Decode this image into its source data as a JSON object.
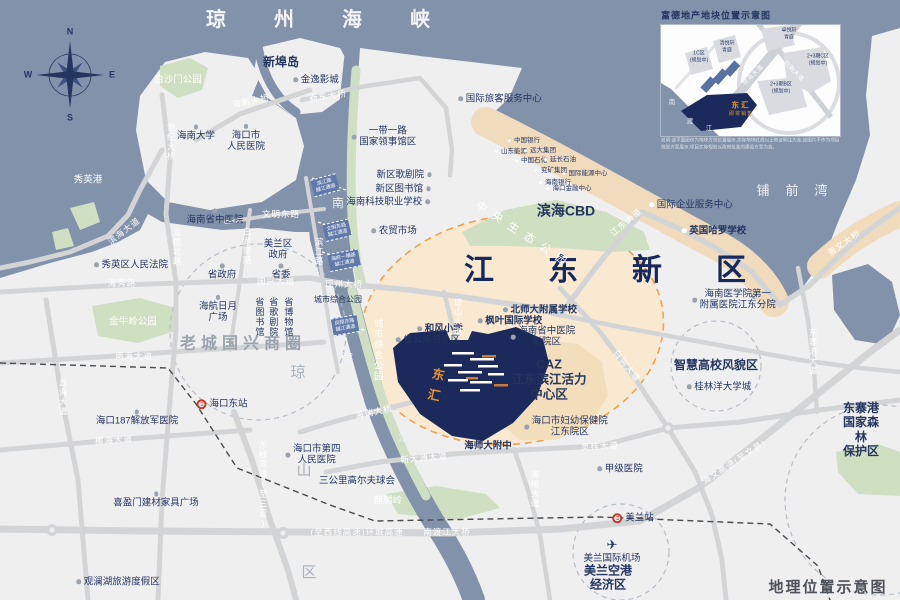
{
  "page": {
    "kind": "real-estate location map",
    "project": "东汇"
  },
  "labels": {
    "sea": [
      {
        "t": "琼州海峡",
        "x": 342,
        "y": 20,
        "c": "seabig",
        "n": "strait-title"
      },
      {
        "t": "铺前湾",
        "x": 800,
        "y": 191,
        "c": "seamed"
      },
      {
        "t": "秀英港",
        "x": 88,
        "y": 180,
        "c": "wsm"
      },
      {
        "t": "南",
        "x": 338,
        "y": 203,
        "c": "riv"
      },
      {
        "t": "渡",
        "x": 347,
        "y": 358,
        "c": "riv"
      },
      {
        "t": "江",
        "x": 404,
        "y": 437,
        "c": "riv"
      }
    ],
    "districts": [
      {
        "t": "江东新区",
        "x": 632,
        "y": 271,
        "c": "dist",
        "n": "district-title"
      },
      {
        "t": "老城国兴商圈",
        "x": 243,
        "y": 344,
        "c": "graybig"
      },
      {
        "t": "滨海CBD",
        "x": 566,
        "y": 211,
        "c": "b s14"
      },
      {
        "t": "CAZ\n江东滨江活力\n中心区",
        "x": 549,
        "y": 380,
        "c": "b s13"
      },
      {
        "t": "智慧高校风貌区",
        "x": 716,
        "y": 365,
        "c": "b s12"
      },
      {
        "t": "美兰空港\n经济区",
        "x": 608,
        "y": 578,
        "c": "b s12"
      },
      {
        "t": "东寨港\n国家森林\n保护区",
        "x": 861,
        "y": 430,
        "c": "b s12"
      },
      {
        "t": "中央生态公园",
        "x": 524,
        "y": 236,
        "c": "wmid",
        "r": 33
      },
      {
        "t": "城市综合公园",
        "x": 338,
        "y": 300,
        "c": "s8"
      },
      {
        "t": "城市综合公园",
        "x": 377,
        "y": 350,
        "c": "wsm v s8"
      },
      {
        "t": "琼",
        "x": 298,
        "y": 373,
        "c": "graych"
      },
      {
        "t": "山",
        "x": 304,
        "y": 471,
        "c": "graych"
      },
      {
        "t": "区",
        "x": 309,
        "y": 573,
        "c": "graych"
      },
      {
        "t": "地理位置示意图",
        "x": 828,
        "y": 588,
        "c": "corner",
        "n": "corner-title"
      }
    ],
    "pois": [
      {
        "t": "新埠岛",
        "x": 281,
        "y": 62,
        "c": "b s12"
      },
      {
        "t": "金逸影城",
        "x": 316,
        "y": 80,
        "d": "l"
      },
      {
        "t": "白沙门公园",
        "x": 178,
        "y": 80,
        "c": "wsm"
      },
      {
        "t": "海南大学",
        "x": 196,
        "y": 133,
        "d": "t"
      },
      {
        "t": "海口市\n人民医院",
        "x": 246,
        "y": 138,
        "d": "t"
      },
      {
        "t": "国际旅客服务中心",
        "x": 500,
        "y": 99,
        "d": "l"
      },
      {
        "t": "一带一路\n国家领事馆区",
        "x": 384,
        "y": 137,
        "d": "l"
      },
      {
        "t": "新区歌剧院",
        "x": 404,
        "y": 175,
        "d": "r"
      },
      {
        "t": "新区图书馆",
        "x": 403,
        "y": 189,
        "d": "r"
      },
      {
        "t": "海南科技职业学校",
        "x": 388,
        "y": 202,
        "d": "r"
      },
      {
        "t": "农贸市场",
        "x": 394,
        "y": 231,
        "d": "l"
      },
      {
        "t": "中国银行",
        "x": 524,
        "y": 141,
        "c": "t7 sm",
        "d": "l",
        "dc": "w"
      },
      {
        "t": "山东能源",
        "x": 511,
        "y": 152,
        "c": "t7 sm",
        "d": "l",
        "dc": "w"
      },
      {
        "t": "远大集团",
        "x": 540,
        "y": 151,
        "c": "t7 sm",
        "d": "l",
        "dc": "w"
      },
      {
        "t": "中国石化",
        "x": 531,
        "y": 161,
        "c": "t7 sm",
        "d": "l",
        "dc": "w"
      },
      {
        "t": "延长石油",
        "x": 560,
        "y": 160,
        "c": "t7 sm",
        "d": "l",
        "dc": "w"
      },
      {
        "t": "兖矿集团",
        "x": 551,
        "y": 171,
        "c": "t7 sm",
        "d": "l",
        "dc": "w"
      },
      {
        "t": "国际能源中心",
        "x": 585,
        "y": 174,
        "c": "t7 sm",
        "d": "l",
        "dc": "w"
      },
      {
        "t": "海南银行",
        "x": 555,
        "y": 183,
        "c": "t7 sm",
        "d": "l",
        "dc": "w"
      },
      {
        "t": "海口金融中心",
        "x": 569,
        "y": 189,
        "c": "t7 sm",
        "d": "l",
        "dc": "w"
      },
      {
        "t": "国际企业服务中心",
        "x": 691,
        "y": 205,
        "d": "l",
        "dc": "w"
      },
      {
        "t": "英国哈罗学校",
        "x": 714,
        "y": 231,
        "c": "b",
        "d": "l",
        "dc": "w"
      },
      {
        "t": "秀英区人民法院",
        "x": 131,
        "y": 265,
        "d": "l"
      },
      {
        "t": "省政府",
        "x": 222,
        "y": 272,
        "d": "t"
      },
      {
        "t": "省委",
        "x": 281,
        "y": 272,
        "d": "t"
      },
      {
        "t": "美兰区\n政府",
        "x": 278,
        "y": 250
      },
      {
        "t": "海航日月\n广场",
        "x": 218,
        "y": 309,
        "d": "t"
      },
      {
        "t": "省图书馆",
        "x": 259,
        "y": 317,
        "c": "v s9"
      },
      {
        "t": "省歌剧院",
        "x": 273,
        "y": 317,
        "c": "v s9"
      },
      {
        "t": "省博物馆",
        "x": 288,
        "y": 317,
        "c": "v s9"
      },
      {
        "t": "海口东站",
        "x": 222,
        "y": 404,
        "i": "rail",
        "n": "haikou-east-station"
      },
      {
        "t": "海口187解放军医院",
        "x": 137,
        "y": 418,
        "d": "t"
      },
      {
        "t": "喜盈门建材家具广场",
        "x": 156,
        "y": 500,
        "d": "t"
      },
      {
        "t": "观澜湖旅游度假区",
        "x": 118,
        "y": 582,
        "d": "l"
      },
      {
        "t": "海口市第四\n人民医院",
        "x": 313,
        "y": 455,
        "d": "l"
      },
      {
        "t": "三公里高尔夫球会",
        "x": 357,
        "y": 481
      },
      {
        "t": "麒麟岭",
        "x": 388,
        "y": 501,
        "c": "wsm"
      },
      {
        "t": "金牛岭公园",
        "x": 133,
        "y": 322,
        "c": "wsm"
      },
      {
        "t": "海南省中医院",
        "x": 215,
        "y": 217,
        "d": "t"
      },
      {
        "t": "和风小学",
        "x": 440,
        "y": 329,
        "c": "b",
        "d": "l"
      },
      {
        "t": "省公务员小区",
        "x": 428,
        "y": 340,
        "d": "l"
      },
      {
        "t": "北师大附属学校",
        "x": 540,
        "y": 310,
        "c": "b",
        "d": "l"
      },
      {
        "t": "枫叶国际学校",
        "x": 510,
        "y": 321,
        "c": "b",
        "d": "l"
      },
      {
        "t": "海南省中医院\n新院区",
        "x": 543,
        "y": 337,
        "d": "l"
      },
      {
        "t": "海口市妇幼保健院\n江东院区",
        "x": 566,
        "y": 427,
        "d": "l"
      },
      {
        "t": "海师大附中",
        "x": 488,
        "y": 446,
        "c": "b"
      },
      {
        "t": "甲级医院",
        "x": 620,
        "y": 469,
        "d": "l"
      },
      {
        "t": "美兰站",
        "x": 633,
        "y": 518,
        "i": "rail",
        "n": "meilan-station"
      },
      {
        "t": "美兰国际机场",
        "x": 612,
        "y": 551,
        "i": "plane",
        "c": "dtop",
        "n": "meilan-airport"
      },
      {
        "t": "桂林洋大学城",
        "x": 719,
        "y": 387,
        "d": "l"
      },
      {
        "t": "海南医学院第一\n附属医院江东分院",
        "x": 734,
        "y": 300,
        "d": "l"
      }
    ],
    "roads": [
      {
        "t": "海新大桥",
        "x": 251,
        "y": 101,
        "c": "rd",
        "r": -12
      },
      {
        "t": "新东大桥",
        "x": 328,
        "y": 96,
        "c": "rd",
        "r": -8
      },
      {
        "t": "世纪大桥",
        "x": 171,
        "y": 142,
        "c": "rd v"
      },
      {
        "t": "滨海大道",
        "x": 124,
        "y": 231,
        "c": "rd",
        "r": -38
      },
      {
        "t": "海秀路",
        "x": 122,
        "y": 283,
        "c": "rd"
      },
      {
        "t": "国兴大道",
        "x": 276,
        "y": 281,
        "c": "rd"
      },
      {
        "t": "文明东路",
        "x": 281,
        "y": 214,
        "c": "rd"
      },
      {
        "t": "白龙南路",
        "x": 247,
        "y": 246,
        "c": "rd v"
      },
      {
        "t": "龙昆北路",
        "x": 177,
        "y": 247,
        "c": "rd v"
      },
      {
        "t": "滨江路",
        "x": 319,
        "y": 252,
        "c": "rd v"
      },
      {
        "t": "琼州大桥",
        "x": 344,
        "y": 284,
        "c": "rd"
      },
      {
        "t": "南海大道",
        "x": 134,
        "y": 356,
        "c": "rd"
      },
      {
        "t": "丘海大道",
        "x": 63,
        "y": 397,
        "c": "rd v"
      },
      {
        "t": "椰海大道",
        "x": 114,
        "y": 440,
        "c": "rd",
        "r": -4
      },
      {
        "t": "东线高速(至三亚)",
        "x": 263,
        "y": 485,
        "c": "rd v s7"
      },
      {
        "t": "(至西线高速)环城高速",
        "x": 357,
        "y": 532,
        "c": "rd"
      },
      {
        "t": "南渡江大桥",
        "x": 447,
        "y": 532,
        "c": "rd"
      },
      {
        "t": "新大洲大道",
        "x": 424,
        "y": 458,
        "c": "rd",
        "r": -5
      },
      {
        "t": "海瑞大桥",
        "x": 374,
        "y": 412,
        "c": "rd",
        "r": -12
      },
      {
        "t": "琼山大道",
        "x": 458,
        "y": 317,
        "c": "rd v"
      },
      {
        "t": "灵桂大道",
        "x": 600,
        "y": 446,
        "c": "rd",
        "r": -3
      },
      {
        "t": "海榆大道",
        "x": 535,
        "y": 489,
        "c": "rd v"
      },
      {
        "t": "白驹大道",
        "x": 627,
        "y": 366,
        "c": "rd",
        "r": 52
      },
      {
        "t": "江东大道",
        "x": 626,
        "y": 222,
        "c": "rd",
        "r": -40
      },
      {
        "t": "东寨港大道",
        "x": 813,
        "y": 352,
        "c": "rd v s7"
      },
      {
        "t": "海文大桥",
        "x": 844,
        "y": 243,
        "c": "rd",
        "r": -35
      },
      {
        "t": "海文高速(至文昌)",
        "x": 734,
        "y": 462,
        "c": "rd s8",
        "r": -33
      }
    ],
    "tags": [
      {
        "t": "滨江路\n越江通道",
        "x": 325,
        "y": 185,
        "c": "btag",
        "r": -15
      },
      {
        "t": "文明东路\n越江通道",
        "x": 337,
        "y": 230,
        "c": "btag",
        "r": -13
      },
      {
        "t": "海府一横路\n越江通道",
        "x": 344,
        "y": 260,
        "c": "btag",
        "r": -11
      },
      {
        "t": "凤翔东路\n越江通道",
        "x": 345,
        "y": 325,
        "c": "btag",
        "r": -10
      }
    ],
    "project": [
      {
        "t": "东\n汇",
        "x": 436,
        "y": 386,
        "c": "oproj",
        "r": 12,
        "n": "project-site-label"
      }
    ],
    "inset": [
      {
        "t": "富德地产地块位置示意图",
        "x": 661,
        "y": 16,
        "c": "instt",
        "a": "l",
        "n": "inset-title"
      },
      {
        "t": "1C区\n(规划中)",
        "x": 699,
        "y": 57,
        "c": "ip"
      },
      {
        "t": "清悦轩\n青庭",
        "x": 727,
        "y": 47,
        "c": "ip"
      },
      {
        "t": "卓悦轩\n青庭",
        "x": 789,
        "y": 34,
        "c": "ip"
      },
      {
        "t": "2+3期C区\n(规划中)",
        "x": 818,
        "y": 60,
        "c": "ip"
      },
      {
        "t": "2+3期B区\n(规划中)",
        "x": 781,
        "y": 88,
        "c": "ip"
      },
      {
        "t": "东汇",
        "x": 741,
        "y": 105,
        "c": "ipj",
        "n": "inset-project-label"
      },
      {
        "t": "即将销售",
        "x": 741,
        "y": 114,
        "c": "ipj2",
        "n": "inset-project-status"
      },
      {
        "t": "琼海大道",
        "x": 754,
        "y": 76,
        "c": "ird",
        "r": -44
      },
      {
        "t": "白驹大道",
        "x": 793,
        "y": 72,
        "c": "ird",
        "r": 46
      },
      {
        "t": "南",
        "x": 672,
        "y": 103,
        "c": "iriv"
      },
      {
        "t": "渡",
        "x": 690,
        "y": 122,
        "c": "iriv"
      },
      {
        "t": "江",
        "x": 709,
        "y": 129,
        "c": "iriv"
      },
      {
        "t": "说明:该平面图仅为地块方向位置展示,实际地块红线以土地证明注为准;该图片不作为项目\n规划方案展示,项目实际规划以政府批准的建设方案为准。",
        "x": 661,
        "y": 144,
        "c": "idisc",
        "a": "l",
        "n": "inset-disclaimer"
      }
    ],
    "compass": [
      {
        "t": "N",
        "x": 70,
        "y": 32,
        "c": "cch"
      },
      {
        "t": "W",
        "x": 28,
        "y": 75,
        "c": "cch"
      },
      {
        "t": "E",
        "x": 112,
        "y": 75,
        "c": "cch"
      },
      {
        "t": "S",
        "x": 70,
        "y": 118,
        "c": "cch"
      }
    ]
  },
  "colors": {
    "sea": "#8292ab",
    "land": "#efeff0",
    "green": "#cfe0c2",
    "road": "#d3d4d6",
    "tan_band": "#f0dcbd",
    "tan_core": "#f8e9d0",
    "caz": "#f3debc",
    "navy_text": "#24355f",
    "project_navy": "#1b2a5b",
    "orange": "#e6952f",
    "orange_dash": "#f0a14d",
    "rail_red": "#c0392b",
    "gray_dash": "#b6bcc6"
  }
}
